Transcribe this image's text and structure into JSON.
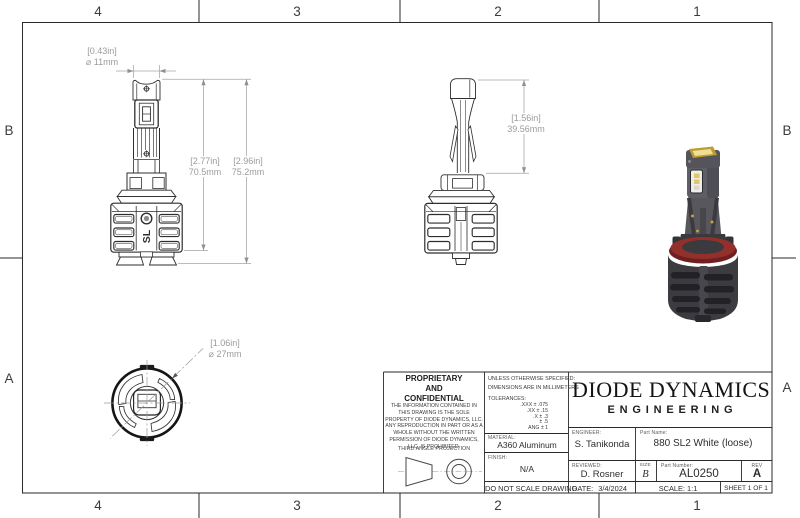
{
  "zones": {
    "top": [
      "4",
      "3",
      "2",
      "1"
    ],
    "bottom": [
      "4",
      "3",
      "2",
      "1"
    ],
    "left": [
      "B",
      "A"
    ],
    "right": [
      "B",
      "A"
    ]
  },
  "dimensions": {
    "front_width": {
      "in": "[0.43in]",
      "mm": "⌀ 11mm"
    },
    "front_height_inner": {
      "in": "[2.77in]",
      "mm": "70.5mm"
    },
    "front_height_outer": {
      "in": "[2.96in]",
      "mm": "75.2mm"
    },
    "side_height": {
      "in": "[1.56in]",
      "mm": "39.56mm"
    },
    "bottom_diameter": {
      "in": "[1.06in]",
      "mm": "⌀ 27mm"
    }
  },
  "views": {
    "sl_logo": "SL"
  },
  "colors": {
    "line": "#2e2e2e",
    "dim_gray": "#9b9b9b",
    "gasket_red": "#93302c",
    "led_amber": "#c9a23e"
  },
  "title_block": {
    "proprietary": {
      "heading": "PROPRIETARY\nAND\nCONFIDENTIAL",
      "body": "THE INFORMATION CONTAINED IN THIS DRAWING IS THE SOLE PROPERTY OF DIODE DYNAMICS, LLC.  ANY REPRODUCTION IN PART OR AS A WHOLE WITHOUT THE WRITTEN PERMISSION OF DIODE DYNAMICS, LLC. IS PROHIBITED.",
      "third_angle": "THIRD ANGLE PROJECTION"
    },
    "specs": {
      "line1": "UNLESS OTHERWISE SPECIFIED:",
      "line2": "DIMENSIONS ARE IN MILLIMETERS",
      "tolerances_heading": "TOLERANCES:",
      "tolerances": [
        ".XXX ± .075",
        ".XX ± .15",
        ".X ± .3",
        "± .5",
        "ANG ± 1"
      ]
    },
    "material": {
      "label": "MATERIAL:",
      "value": "A360 Aluminum"
    },
    "finish": {
      "label": "FINISH:",
      "value": "N/A"
    },
    "do_not_scale": "DO NOT SCALE DRAWING",
    "engineer": {
      "label": "ENGINEER:",
      "value": "S. Tanikonda"
    },
    "reviewed": {
      "label": "REVIEWED:",
      "value": "D. Rosner"
    },
    "date": {
      "label": "DATE:",
      "value": "3/4/2024"
    },
    "company": {
      "name": "DIODE DYNAMICS",
      "division": "ENGINEERING"
    },
    "part_name": {
      "label": "Part Name:",
      "value": "880 SL2 White (loose)"
    },
    "size": {
      "label": "SIZE",
      "value": "B"
    },
    "part_number": {
      "label": "Part Number:",
      "value": "AL0250"
    },
    "rev": {
      "label": "REV",
      "value": "A"
    },
    "scale": "SCALE: 1:1",
    "sheet": "SHEET 1 OF 1"
  }
}
